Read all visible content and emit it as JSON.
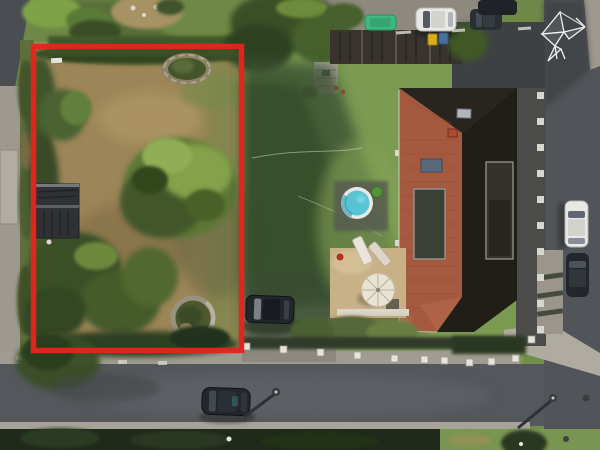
{
  "image": {
    "kind": "aerial drone photograph",
    "description": "Top-down aerial view of a residential corner property. A vacant garden plot with dried grass, large trees, hedges, a round flower bed, a stone garden circle and a dark shed is outlined with a thick red rectangle. To the right is a house with a red hip roof (one side in deep shadow), a round above-ground pool, a terrace with a white parasol and sun loungers, white fence posts, parked cars, waste bins and asphalt streets along the bottom and right edges. A white origami-bird watermark logo sits in the top-right corner.",
    "width_px": 600,
    "height_px": 450
  },
  "annotations": {
    "property_boundary": {
      "shape": "rectangle",
      "color": "#e8231c",
      "stroke_width_px": 5.5
    }
  },
  "watermark": {
    "icon": "origami-bird-logo",
    "color": "#ffffff",
    "position": "top-right"
  },
  "scene": {
    "marked_plot": [
      "dried lawn",
      "large deciduous tree",
      "perimeter hedges",
      "round stone flower bed",
      "stone garden circle",
      "dark garden shed"
    ],
    "neighboring_property": [
      "house with red hip roof",
      "shaded dark roof side",
      "roof windows",
      "solar panel",
      "skylight",
      "chimney",
      "round above-ground pool",
      "white parasol",
      "sun loungers",
      "terrace",
      "lawn with large tree shadow",
      "white fence posts"
    ],
    "vehicles": [
      "white car (top driveway)",
      "dark car (top driveway)",
      "dark car (top corner)",
      "green car",
      "dark car (side driveway)",
      "white car (right street)",
      "dark car (right street)",
      "dark car (bottom street)"
    ],
    "street_furniture": [
      "street lamp (bottom)",
      "street lamp (corner)",
      "waste bin yellow",
      "waste bin blue",
      "garden fence panels",
      "parking markings"
    ],
    "roads": [
      "asphalt street along bottom edge",
      "asphalt street along right edge",
      "sidewalks",
      "driveways",
      "access road top-left"
    ]
  },
  "colors": {
    "boundary_red": "#e8231c",
    "lawn": "#72904c",
    "dried_grass": "#9c8557",
    "asphalt": "#54575b",
    "sidewalk": "#a19c91",
    "roof_tiles": "#a55a40",
    "roof_shaded": "#211d17",
    "pool_water": "#57c3d3",
    "parasol": "#e9e3d3",
    "car_white": "#e8e8e6",
    "car_dark": "#23262b",
    "car_green": "#3eb97e",
    "bin_yellow": "#d9b01c",
    "bin_blue": "#4a6e9e",
    "watermark_white": "#ffffff"
  }
}
